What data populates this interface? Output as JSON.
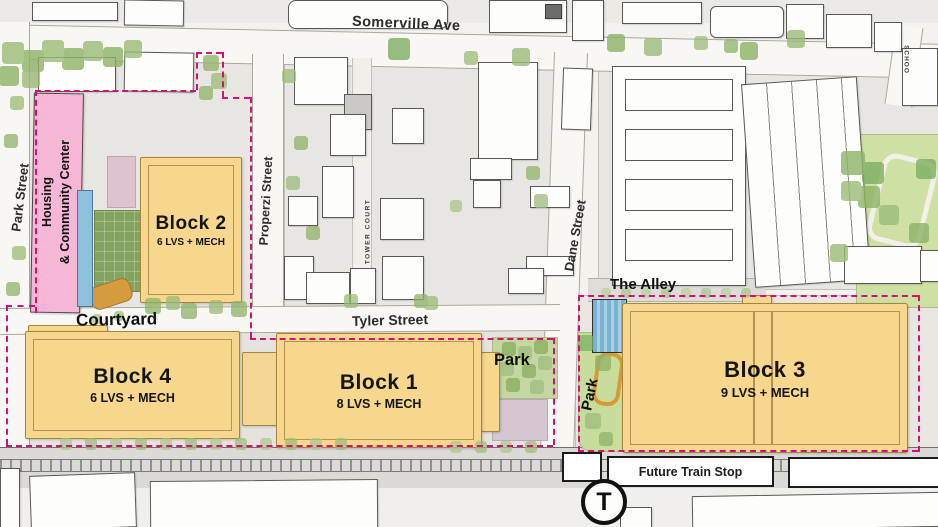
{
  "map": {
    "streets": {
      "somerville": "Somerville Ave",
      "park": "Park Street",
      "properzi": "Properzi Street",
      "tower_court": "TOWER COURT",
      "dane": "Dane Street",
      "tyler": "Tyler Street",
      "school": "SCHOO"
    },
    "areas": {
      "housing_line1": "Housing",
      "housing_line2": "& Community Center",
      "courtyard": "Courtyard",
      "alley": "The Alley",
      "park_east": "Park",
      "park_west": "Park"
    },
    "blocks": [
      {
        "name": "Block 2",
        "levels": "6 LVS + MECH"
      },
      {
        "name": "Block 4",
        "levels": "6 LVS + MECH"
      },
      {
        "name": "Block 1",
        "levels": "8 LVS + MECH"
      },
      {
        "name": "Block 3",
        "levels": "9 LVS + MECH"
      }
    ],
    "transit": {
      "future_train_stop": "Future Train Stop",
      "t_logo": "T"
    },
    "colors": {
      "block_fill": "#f6d78d",
      "block_border": "#a8853d",
      "housing_fill": "#f6b6d5",
      "boundary_dash": "#cf1273",
      "park_green": "#cfe0a4",
      "lawn_green": "#83a45e",
      "water_blue": "#8cc0dd",
      "mauve": "#d6c6d2"
    }
  }
}
